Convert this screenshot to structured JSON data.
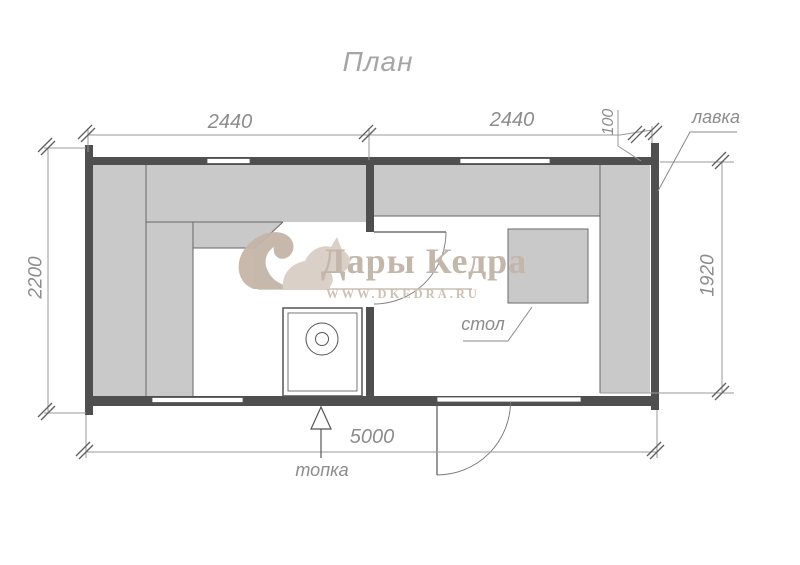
{
  "title": "План",
  "drawing": {
    "dimensions": {
      "module_left": "2440",
      "module_right": "2440",
      "offset_small": "100",
      "height_left": "2200",
      "height_right_inner": "1920",
      "width_total": "5000"
    },
    "labels": {
      "bench": "лавка",
      "table": "стол",
      "firebox": "топка"
    }
  },
  "watermark": {
    "brand": "Дары Кедра",
    "website": "WWW.DKEDRA.RU",
    "logo": "squirrel"
  },
  "colors": {
    "wall": "#4f4f4f",
    "bench_fill": "#c9c9c9",
    "bench_edge": "#666666",
    "dim_line": "#9a9a9a",
    "dim_text": "#8c8c8c",
    "watermark_text": "#c3b6aa",
    "background": "#ffffff"
  }
}
